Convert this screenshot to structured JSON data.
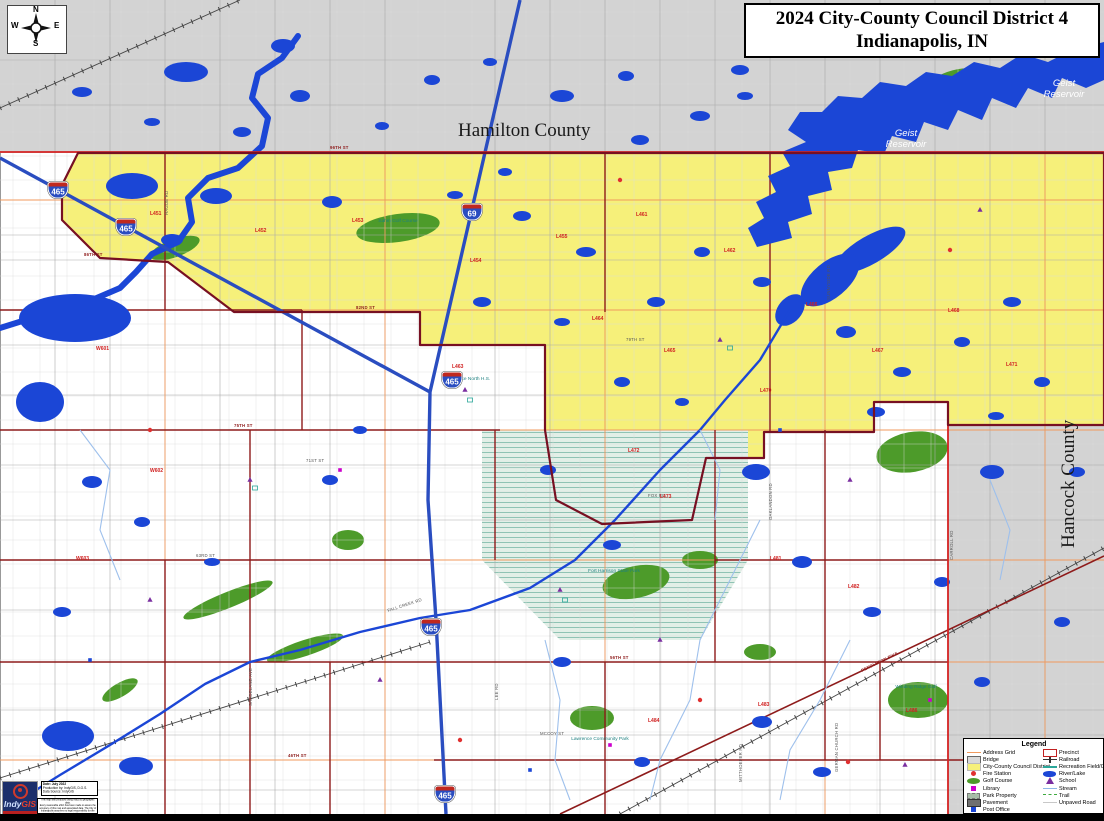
{
  "title": {
    "line1": "2024 City-County Council District 4",
    "line2": "Indianapolis, IN"
  },
  "compass": {
    "n": "N",
    "e": "E",
    "s": "S",
    "w": "W"
  },
  "map_labels": {
    "hamilton_county": "Hamilton County",
    "hancock_county": "Hancock County",
    "geist_line1": "Geist",
    "geist_line2": "Reservoir"
  },
  "colors": {
    "water": "#1b46d6",
    "district": "#f6f07a",
    "county_gray": "#d3d3d3",
    "precinct_line": "#8e1b1b",
    "interstate_blue": "#2a4dc0",
    "county_line_red": "#d42222"
  },
  "legend": {
    "title": "Legend",
    "left": [
      {
        "label": "Address Grid",
        "key": "address-grid"
      },
      {
        "label": "Bridge",
        "key": "bridge"
      },
      {
        "label": "City-County Council District",
        "key": "district"
      },
      {
        "label": "Fire Station",
        "key": "fire"
      },
      {
        "label": "Golf Course",
        "key": "golf"
      },
      {
        "label": "Library",
        "key": "library"
      },
      {
        "label": "Park Property",
        "key": "park"
      },
      {
        "label": "Pavement",
        "key": "pavement"
      },
      {
        "label": "Post Office",
        "key": "post"
      }
    ],
    "right": [
      {
        "label": "Precinct",
        "key": "precinct"
      },
      {
        "label": "Railroad",
        "key": "railroad"
      },
      {
        "label": "Recreation Field/Court",
        "key": "recreation"
      },
      {
        "label": "River/Lake",
        "key": "river"
      },
      {
        "label": "School",
        "key": "school"
      },
      {
        "label": "Stream",
        "key": "stream"
      },
      {
        "label": "Trail",
        "key": "trail"
      },
      {
        "label": "Unpaved Road",
        "key": "unpaved"
      }
    ]
  },
  "logo": {
    "brand_indy": "Indy",
    "brand_gis": "GIS"
  },
  "credits": {
    "date": "Date: July 2022",
    "produced": "Production by: IndyGIS, D.G.S.",
    "source": "Data Source: IndyGIS"
  },
  "disclaimer": [
    "This map was produced using IndyGIS geographic data.",
    "Every reasonable effort has been made to assure the",
    "accuracy of this map and associated data. The City of",
    "Indianapolis assumes no legal responsibility for the",
    "information represented herein."
  ],
  "map": {
    "shields": [
      {
        "num": "465",
        "x": 58,
        "y": 190
      },
      {
        "num": "465",
        "x": 126,
        "y": 227
      },
      {
        "num": "69",
        "x": 472,
        "y": 212
      },
      {
        "num": "465",
        "x": 452,
        "y": 380
      },
      {
        "num": "465",
        "x": 431,
        "y": 627
      },
      {
        "num": "465",
        "x": 445,
        "y": 794
      }
    ],
    "street_labels": [
      {
        "t": "96TH ST",
        "x": 330,
        "y": 149,
        "r": 0,
        "c": "major"
      },
      {
        "t": "86TH ST",
        "x": 84,
        "y": 256,
        "r": 0,
        "c": "major"
      },
      {
        "t": "82ND ST",
        "x": 356,
        "y": 309,
        "r": 0,
        "c": "major"
      },
      {
        "t": "79TH ST",
        "x": 626,
        "y": 341,
        "r": 0,
        "c": "minor"
      },
      {
        "t": "75TH ST",
        "x": 234,
        "y": 427,
        "r": 0,
        "c": "major"
      },
      {
        "t": "71ST ST",
        "x": 306,
        "y": 462,
        "r": 0,
        "c": "minor"
      },
      {
        "t": "63RD ST",
        "x": 196,
        "y": 557,
        "r": 0,
        "c": "minor"
      },
      {
        "t": "56TH ST",
        "x": 610,
        "y": 659,
        "r": 0,
        "c": "major"
      },
      {
        "t": "46TH ST",
        "x": 288,
        "y": 757,
        "r": 0,
        "c": "major"
      },
      {
        "t": "FALL CREEK RD",
        "x": 388,
        "y": 612,
        "r": -18,
        "c": "minor"
      },
      {
        "t": "PENDLETON PIKE",
        "x": 862,
        "y": 672,
        "r": -26,
        "c": "major"
      },
      {
        "t": "OAKLANDON RD",
        "x": 772,
        "y": 520,
        "r": -90,
        "c": "minor"
      },
      {
        "t": "SUNNYSIDE RD",
        "x": 830,
        "y": 300,
        "r": -90,
        "c": "minor"
      },
      {
        "t": "GERMAN CHURCH RD",
        "x": 838,
        "y": 772,
        "r": -90,
        "c": "minor"
      },
      {
        "t": "MITTHOEFER RD",
        "x": 742,
        "y": 782,
        "r": -90,
        "c": "minor"
      },
      {
        "t": "LEE RD",
        "x": 498,
        "y": 700,
        "r": -90,
        "c": "minor"
      },
      {
        "t": "SHADELAND AVE",
        "x": 252,
        "y": 706,
        "r": -90,
        "c": "minor"
      },
      {
        "t": "HAGUE RD",
        "x": 168,
        "y": 215,
        "r": -90,
        "c": "minor"
      },
      {
        "t": "CARROLL RD",
        "x": 953,
        "y": 560,
        "r": -90,
        "c": "minor"
      },
      {
        "t": "FOX RD",
        "x": 648,
        "y": 497,
        "r": 0,
        "c": "minor"
      },
      {
        "t": "MCCOY ST",
        "x": 540,
        "y": 735,
        "r": 0,
        "c": "minor"
      }
    ],
    "precinct_labels": [
      {
        "t": "L451",
        "x": 150,
        "y": 215
      },
      {
        "t": "L452",
        "x": 255,
        "y": 232
      },
      {
        "t": "L453",
        "x": 352,
        "y": 222
      },
      {
        "t": "L454",
        "x": 470,
        "y": 262
      },
      {
        "t": "L455",
        "x": 556,
        "y": 238
      },
      {
        "t": "L461",
        "x": 636,
        "y": 216
      },
      {
        "t": "L462",
        "x": 724,
        "y": 252
      },
      {
        "t": "L463",
        "x": 452,
        "y": 368
      },
      {
        "t": "L464",
        "x": 592,
        "y": 320
      },
      {
        "t": "L465",
        "x": 664,
        "y": 352
      },
      {
        "t": "L466",
        "x": 806,
        "y": 306
      },
      {
        "t": "L467",
        "x": 872,
        "y": 352
      },
      {
        "t": "L468",
        "x": 948,
        "y": 312
      },
      {
        "t": "L470",
        "x": 760,
        "y": 392
      },
      {
        "t": "L471",
        "x": 1006,
        "y": 366
      },
      {
        "t": "L472",
        "x": 628,
        "y": 452
      },
      {
        "t": "L473",
        "x": 660,
        "y": 498
      },
      {
        "t": "W601",
        "x": 96,
        "y": 350
      },
      {
        "t": "W602",
        "x": 150,
        "y": 472
      },
      {
        "t": "W603",
        "x": 76,
        "y": 560
      },
      {
        "t": "L481",
        "x": 770,
        "y": 560
      },
      {
        "t": "L482",
        "x": 848,
        "y": 588
      },
      {
        "t": "L483",
        "x": 758,
        "y": 706
      },
      {
        "t": "L484",
        "x": 648,
        "y": 722
      },
      {
        "t": "L486",
        "x": 906,
        "y": 712
      }
    ],
    "facility_labels": [
      {
        "t": "Sahm Golf Course",
        "x": 398,
        "y": 222
      },
      {
        "t": "Lawrence North H.S.",
        "x": 468,
        "y": 380
      },
      {
        "t": "Fort Harrison State Park",
        "x": 614,
        "y": 572
      },
      {
        "t": "Winding Ridge Golf",
        "x": 916,
        "y": 688
      },
      {
        "t": "Lawrence Community Park",
        "x": 600,
        "y": 740
      }
    ],
    "greens": [
      [
        398,
        228,
        42,
        14,
        -8
      ],
      [
        175,
        248,
        26,
        9,
        -20
      ],
      [
        912,
        452,
        36,
        20,
        -10
      ],
      [
        918,
        700,
        30,
        18,
        0
      ],
      [
        348,
        540,
        16,
        10,
        0
      ],
      [
        636,
        582,
        34,
        16,
        -12
      ],
      [
        228,
        600,
        48,
        8,
        -22
      ],
      [
        305,
        648,
        40,
        8,
        -18
      ],
      [
        760,
        652,
        16,
        8,
        0
      ],
      [
        592,
        718,
        22,
        12,
        0
      ],
      [
        955,
        80,
        26,
        10,
        -15
      ],
      [
        700,
        560,
        18,
        9,
        0
      ],
      [
        120,
        690,
        20,
        7,
        -30
      ]
    ],
    "ponds": [
      [
        186,
        72,
        22,
        10
      ],
      [
        283,
        46,
        12,
        7
      ],
      [
        300,
        96,
        10,
        6
      ],
      [
        562,
        96,
        12,
        6
      ],
      [
        626,
        76,
        8,
        5
      ],
      [
        700,
        116,
        10,
        5
      ],
      [
        745,
        96,
        8,
        4
      ],
      [
        640,
        140,
        9,
        5
      ],
      [
        432,
        80,
        8,
        5
      ],
      [
        82,
        92,
        10,
        5
      ],
      [
        152,
        122,
        8,
        4
      ],
      [
        242,
        132,
        9,
        5
      ],
      [
        382,
        126,
        7,
        4
      ],
      [
        490,
        62,
        7,
        4
      ],
      [
        740,
        70,
        9,
        5
      ],
      [
        132,
        186,
        26,
        13
      ],
      [
        216,
        196,
        16,
        8
      ],
      [
        172,
        240,
        11,
        6
      ],
      [
        332,
        202,
        10,
        6
      ],
      [
        522,
        216,
        9,
        5
      ],
      [
        586,
        252,
        10,
        5
      ],
      [
        656,
        302,
        9,
        5
      ],
      [
        702,
        252,
        8,
        5
      ],
      [
        762,
        282,
        9,
        5
      ],
      [
        846,
        332,
        10,
        6
      ],
      [
        902,
        372,
        9,
        5
      ],
      [
        962,
        342,
        8,
        5
      ],
      [
        1012,
        302,
        9,
        5
      ],
      [
        1042,
        382,
        8,
        5
      ],
      [
        562,
        322,
        8,
        4
      ],
      [
        482,
        302,
        9,
        5
      ],
      [
        622,
        382,
        8,
        5
      ],
      [
        682,
        402,
        7,
        4
      ],
      [
        876,
        412,
        9,
        5
      ],
      [
        996,
        416,
        8,
        4
      ],
      [
        455,
        195,
        8,
        4
      ],
      [
        505,
        172,
        7,
        4
      ],
      [
        92,
        482,
        10,
        6
      ],
      [
        142,
        522,
        8,
        5
      ],
      [
        62,
        612,
        9,
        5
      ],
      [
        212,
        562,
        8,
        4
      ],
      [
        330,
        480,
        8,
        5
      ],
      [
        360,
        430,
        7,
        4
      ],
      [
        75,
        318,
        56,
        24
      ],
      [
        40,
        402,
        24,
        20
      ],
      [
        68,
        736,
        26,
        15
      ],
      [
        136,
        766,
        17,
        9
      ],
      [
        756,
        472,
        14,
        8
      ],
      [
        802,
        562,
        10,
        6
      ],
      [
        872,
        612,
        9,
        5
      ],
      [
        942,
        582,
        8,
        5
      ],
      [
        762,
        722,
        10,
        6
      ],
      [
        822,
        772,
        9,
        5
      ],
      [
        642,
        762,
        8,
        5
      ],
      [
        562,
        662,
        9,
        5
      ],
      [
        982,
        682,
        8,
        5
      ],
      [
        1012,
        762,
        9,
        5
      ],
      [
        1062,
        622,
        8,
        5
      ],
      [
        1077,
        472,
        8,
        5
      ],
      [
        992,
        472,
        12,
        7
      ],
      [
        612,
        545,
        9,
        5
      ],
      [
        548,
        470,
        8,
        5
      ]
    ],
    "pois": [
      {
        "type": "fire",
        "x": 150,
        "y": 430
      },
      {
        "type": "fire",
        "x": 460,
        "y": 740
      },
      {
        "type": "fire",
        "x": 700,
        "y": 700
      },
      {
        "type": "fire",
        "x": 848,
        "y": 762
      },
      {
        "type": "fire",
        "x": 620,
        "y": 180
      },
      {
        "type": "fire",
        "x": 950,
        "y": 250
      },
      {
        "type": "post",
        "x": 90,
        "y": 660
      },
      {
        "type": "post",
        "x": 530,
        "y": 770
      },
      {
        "type": "post",
        "x": 780,
        "y": 430
      },
      {
        "type": "library",
        "x": 340,
        "y": 470
      },
      {
        "type": "library",
        "x": 610,
        "y": 745
      },
      {
        "type": "library",
        "x": 930,
        "y": 700
      },
      {
        "type": "school",
        "x": 465,
        "y": 390
      },
      {
        "type": "school",
        "x": 250,
        "y": 480
      },
      {
        "type": "school",
        "x": 380,
        "y": 680
      },
      {
        "type": "school",
        "x": 560,
        "y": 590
      },
      {
        "type": "school",
        "x": 720,
        "y": 340
      },
      {
        "type": "school",
        "x": 850,
        "y": 480
      },
      {
        "type": "school",
        "x": 980,
        "y": 210
      },
      {
        "type": "school",
        "x": 660,
        "y": 640
      },
      {
        "type": "school",
        "x": 905,
        "y": 765
      },
      {
        "type": "school",
        "x": 150,
        "y": 600
      },
      {
        "type": "rec",
        "x": 470,
        "y": 400
      },
      {
        "type": "rec",
        "x": 255,
        "y": 488
      },
      {
        "type": "rec",
        "x": 565,
        "y": 600
      },
      {
        "type": "rec",
        "x": 730,
        "y": 348
      }
    ]
  }
}
